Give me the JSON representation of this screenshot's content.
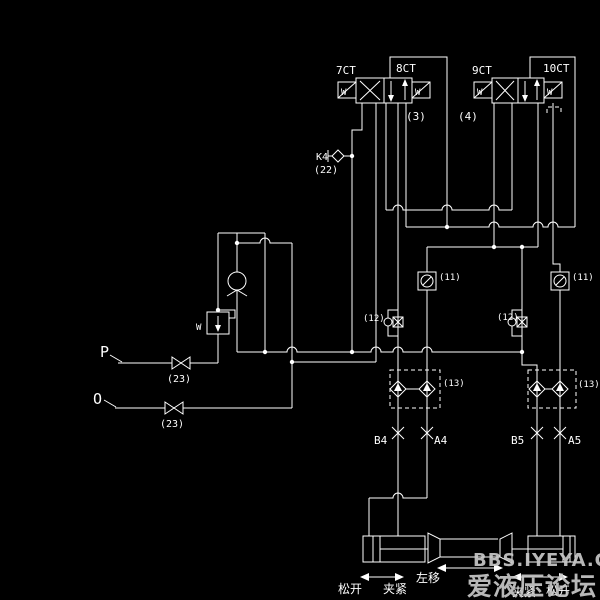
{
  "diagram_title": "hydraulic clamping circuit schematic",
  "colors": {
    "background": "#000000",
    "line": "#ffffff",
    "watermark": "#c8c8c8"
  },
  "valve3": {
    "left_tag": "7CT",
    "right_tag": "8CT",
    "number": "(3)",
    "spring": "W"
  },
  "valve4": {
    "left_tag": "9CT",
    "right_tag": "10CT",
    "number": "(4)",
    "spring": "W"
  },
  "test_point": {
    "label": "K4",
    "number": "(22)"
  },
  "supply": {
    "p_label": "P",
    "o_label": "O",
    "shutoff_number": "(23)",
    "relief_spring": "W"
  },
  "components": {
    "check_block": "(11)",
    "gauge_block": "(12)",
    "pilot_check_block": "(13)"
  },
  "ports": {
    "b4": "B4",
    "a4": "A4",
    "b5": "B5",
    "a5": "A5"
  },
  "motion": {
    "left_release": "松开",
    "left_clamp": "夹紧",
    "move_left": "左移",
    "right_clamp": "夹紧",
    "right_release": "松开"
  },
  "watermark": {
    "line1": "BBS.IYEYA.CN",
    "line2": "爱液压论坛"
  }
}
